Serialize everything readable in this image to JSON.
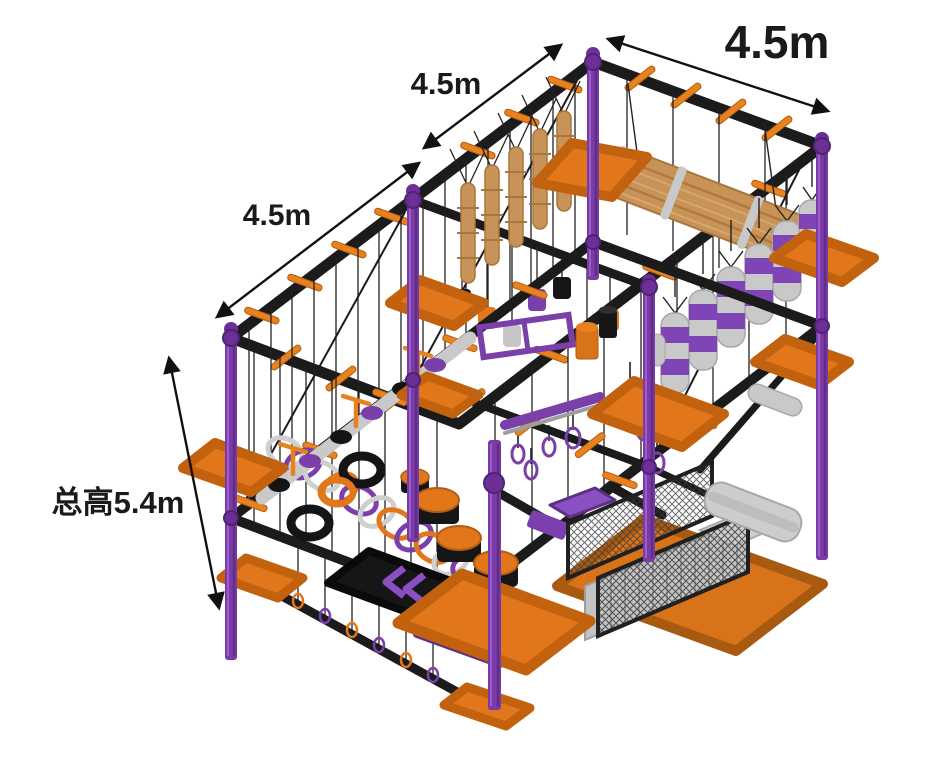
{
  "labels": {
    "dim_top_right": "4.5m",
    "dim_upper_middle": "4.5m",
    "dim_left": "4.5m",
    "dim_total_height": "总高5.4m"
  },
  "palette": {
    "background": "#ffffff",
    "beam_black": "#1b1b1b",
    "pole_purple": "#7c3aa8",
    "purple_dark": "#5e2f85",
    "panel_purple": "#7b3fae",
    "band_purple": "#7f44b5",
    "platform_orange": "#e2761b",
    "platform_orange_dark": "#b35b12",
    "rung_orange": "#e8821e",
    "wood_tan": "#c79359",
    "wood_tan_dark": "#a9763d",
    "metal_gray": "#c6c6c6",
    "rope_black": "#222222",
    "annotation_black": "#111111"
  }
}
